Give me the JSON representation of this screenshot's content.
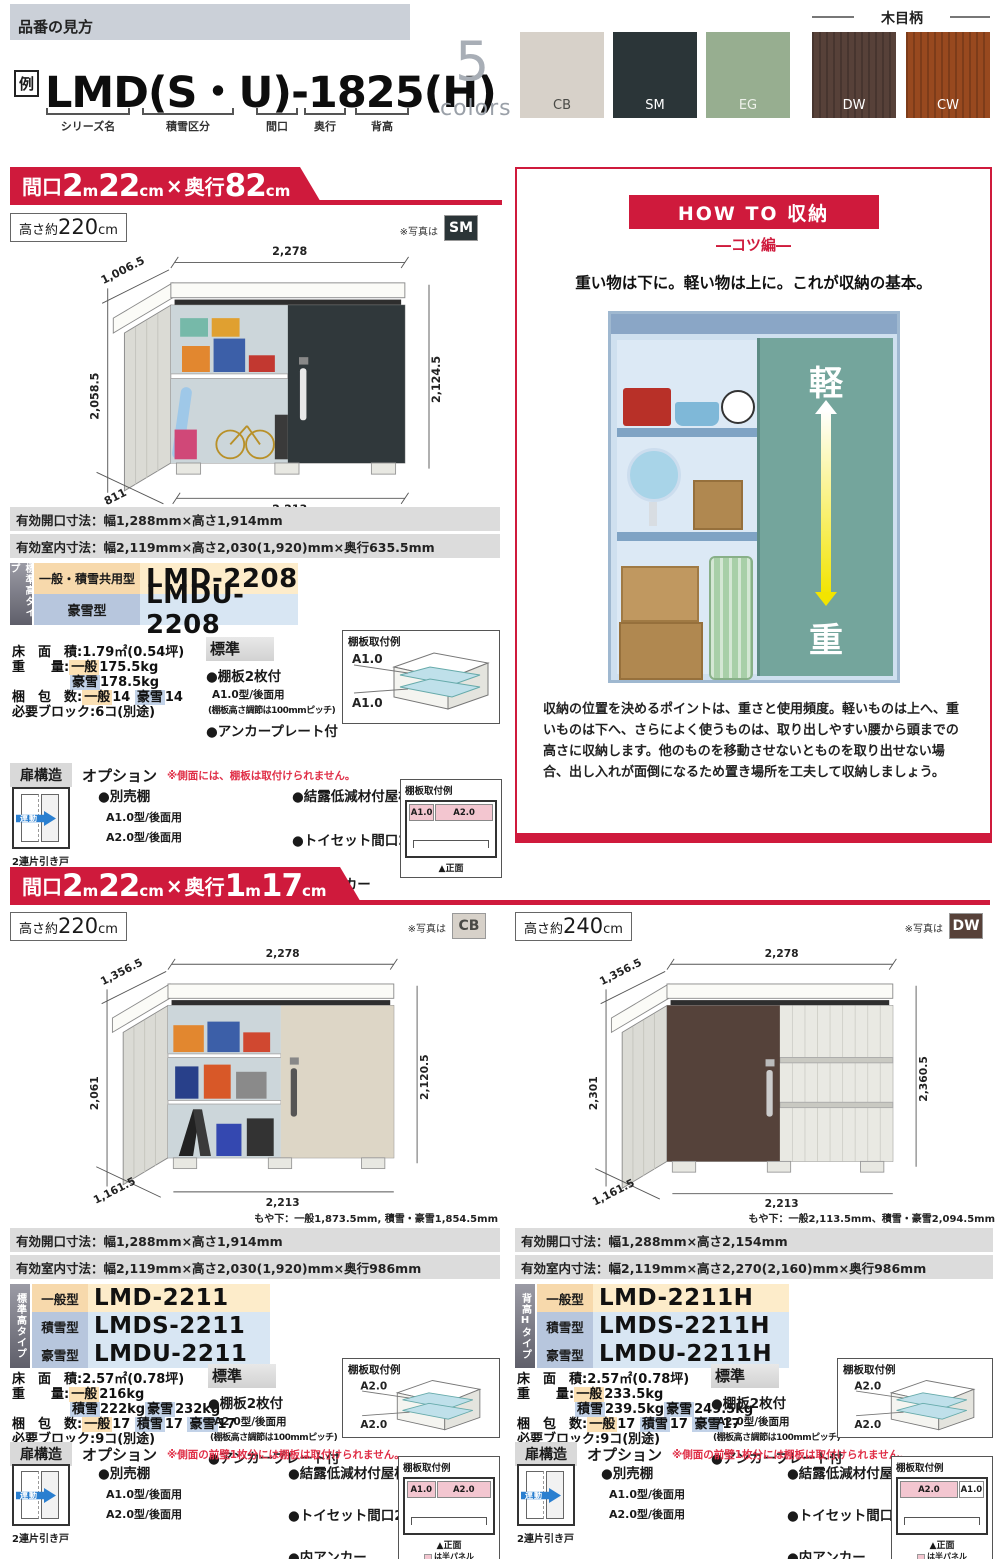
{
  "palette": {
    "red": "#cf1a3c"
  },
  "header": {
    "section_label": "品番の見方",
    "example_badge": "例",
    "model_example": "LMD(S・U)-1825(H)",
    "part_labels": [
      "シリーズ名",
      "積雪区分",
      "間口",
      "奥行",
      "背高"
    ],
    "colors_count": "5",
    "colors_word": "colors",
    "wood_grain_label": "木目柄",
    "swatches": [
      {
        "code": "CB",
        "bg": "#d7d1c9",
        "fg": "#4a4a46"
      },
      {
        "code": "SM",
        "bg": "#2b3538",
        "fg": "#ffffff"
      },
      {
        "code": "EG",
        "bg": "#97ae90",
        "fg": "#eef2ea"
      },
      {
        "code": "DW",
        "bg": "#574139",
        "fg": "#ffffff"
      },
      {
        "code": "CW",
        "bg": "#98491f",
        "fg": "#ffffff"
      }
    ]
  },
  "howto": {
    "title": "HOW TO 収納",
    "subtitle": "―コツ編―",
    "lead": "重い物は下に。軽い物は上に。これが収納の基本。",
    "light_char": "軽",
    "heavy_char": "重",
    "body": "収納の位置を決めるポイントは、重さと使用頻度。軽いものは上へ、重いものは下へ、さらによく使うものは、取り出しやすい腰から頭までの高さに収納します。他のものを移動させないとものを取り出せない場合、出し入れが面倒になるため置き場所を工夫して収納しましょう。"
  },
  "s1": {
    "banner": {
      "p1": "間口",
      "n1": "2",
      "u1": "m",
      "n2": "22",
      "u2": "cm",
      "x": "×",
      "p2": "奥行",
      "n3": "82",
      "u3": "cm"
    },
    "height": {
      "pre": "高さ約",
      "num": "220",
      "unit": "cm"
    },
    "photo_note": "※写真は",
    "photo_badge": {
      "code": "SM",
      "bg": "#2b3538",
      "fg": "#ffffff"
    },
    "dims": {
      "dtl": "1,006.5",
      "dt": "2,278",
      "dl": "2,058.5",
      "dr": "2,124.5",
      "dbl": "811",
      "db": "2,213"
    },
    "spec_open": "有効開口寸法：幅1,288mm×高さ1,914mm",
    "spec_inner": "有効室内寸法：幅2,119mm×高さ2,030(1,920)mm×奥行635.5mm",
    "models": {
      "tab": "標準高タイプ",
      "rows": [
        {
          "type": "一般・積雪共用型",
          "name": "LMD-2208"
        },
        {
          "type": "豪雪型",
          "name": "LMDU-2208"
        }
      ]
    },
    "specs": {
      "floor_l": "床　面　積:",
      "floor_v": "1.79㎡(0.54坪)",
      "weight_l": "重　　量:",
      "wt1_tag": "一般",
      "wt1_v": "175.5kg",
      "wt2_tag": "豪雪",
      "wt2_v": "178.5kg",
      "pack_l": "梱　包　数:",
      "pk1_tag": "一般",
      "pk1_v": "14",
      "pk2_tag": "豪雪",
      "pk2_v": "14",
      "block": "必要ブロック:6コ(別途)"
    },
    "standard": {
      "title": "標準",
      "i1": "●棚板2枚付",
      "i2": "A1.0型/後面用",
      "i3": "(棚板高さ調節は100mmピッチ)",
      "i4": "●アンカープレート付"
    },
    "shelf3d": {
      "title": "棚板取付例",
      "l1": "A1.0",
      "l2": "A1.0"
    },
    "dooropt": {
      "door_title": "扉構造",
      "opt_title": "オプション",
      "note": "※側面には、棚板は取付けられません。",
      "door_arrow": "連動",
      "door_caption": "2連片引き戸",
      "o1": "●別売棚",
      "o1a": "A1.0型/後面用",
      "o1b": "A2.0型/後面用",
      "o2": "●結露低減材付屋根",
      "o3": "●トイセット間口22用",
      "o4": "●内アンカー",
      "front": {
        "title": "棚板取付例",
        "c1": "A1.0",
        "c2": "A2.0",
        "caption": "▲正面"
      }
    }
  },
  "s2": {
    "banner": {
      "p1": "間口",
      "n1": "2",
      "u1": "m",
      "n2": "22",
      "u2": "cm",
      "x": "×",
      "p2": "奥行",
      "n3": "1",
      "u3": "m",
      "n4": "17",
      "u4": "cm"
    }
  },
  "s2l": {
    "height": {
      "pre": "高さ約",
      "num": "220",
      "unit": "cm"
    },
    "photo_note": "※写真は",
    "photo_badge": {
      "code": "CB",
      "bg": "#d7d1c9",
      "fg": "#4a4a46"
    },
    "dims": {
      "dtl": "1,356.5",
      "dt": "2,278",
      "dl": "2,061",
      "dr": "2,120.5",
      "dbl": "1,161.5",
      "db": "2,213"
    },
    "moya": "もや下：一般1,873.5mm, 積雪・豪雪1,854.5mm",
    "spec_open": "有効開口寸法：幅1,288mm×高さ1,914mm",
    "spec_inner": "有効室内寸法：幅2,119mm×高さ2,030(1,920)mm×奥行986mm",
    "models": {
      "tab": "標準高タイプ",
      "rows": [
        {
          "type": "一般型",
          "name": "LMD-2211"
        },
        {
          "type": "積雪型",
          "name": "LMDS-2211"
        },
        {
          "type": "豪雪型",
          "name": "LMDU-2211"
        }
      ]
    },
    "specs": {
      "floor_l": "床　面　積:",
      "floor_v": "2.57㎡(0.78坪)",
      "weight_l": "重　　量:",
      "wt1_tag": "一般",
      "wt1_v": "216kg",
      "wt2_tag": "積雪",
      "wt2_v": "222kg",
      "wt3_tag": "豪雪",
      "wt3_v": "232kg",
      "pack_l": "梱　包　数:",
      "pk1_tag": "一般",
      "pk1_v": "17",
      "pk2_tag": "積雪",
      "pk2_v": "17",
      "pk3_tag": "豪雪",
      "pk3_v": "17",
      "block": "必要ブロック:9コ(別途)"
    },
    "standard": {
      "title": "標準",
      "i1": "●棚板2枚付",
      "i2": "A2.0型/後面用",
      "i3": "(棚板高さ調節は100mmピッチ)",
      "i4": "●アンカープレート付"
    },
    "shelf3d": {
      "title": "棚板取付例",
      "l1": "A2.0",
      "l2": "A2.0"
    },
    "dooropt": {
      "door_title": "扉構造",
      "opt_title": "オプション",
      "note": "※側面の前壁1枚分には棚板は取付けられません。",
      "door_arrow": "連動",
      "door_caption": "2連片引き戸",
      "o1": "●別売棚",
      "o1a": "A1.0型/後面用",
      "o1b": "A2.0型/後面用",
      "o2": "●結露低減材付屋根",
      "o3": "●トイセット間口22用",
      "o4": "●内アンカー",
      "front": {
        "title": "棚板取付例",
        "c1": "A1.0",
        "c2": "A2.0",
        "caption": "▲正面",
        "legend": "は半パネル"
      }
    }
  },
  "s2r": {
    "height": {
      "pre": "高さ約",
      "num": "240",
      "unit": "cm"
    },
    "photo_note": "※写真は",
    "photo_badge": {
      "code": "DW",
      "bg": "#574139",
      "fg": "#ffffff"
    },
    "dims": {
      "dtl": "1,356.5",
      "dt": "2,278",
      "dl": "2,301",
      "dr": "2,360.5",
      "dbl": "1,161.5",
      "db": "2,213"
    },
    "moya": "もや下：一般2,113.5mm、積雪・豪雪2,094.5mm",
    "spec_open": "有効開口寸法：幅1,288mm×高さ2,154mm",
    "spec_inner": "有効室内寸法：幅2,119mm×高さ2,270(2,160)mm×奥行986mm",
    "models": {
      "tab": "背高Hタイプ",
      "rows": [
        {
          "type": "一般型",
          "name": "LMD-2211H"
        },
        {
          "type": "積雪型",
          "name": "LMDS-2211H"
        },
        {
          "type": "豪雪型",
          "name": "LMDU-2211H"
        }
      ]
    },
    "specs": {
      "floor_l": "床　面　積:",
      "floor_v": "2.57㎡(0.78坪)",
      "weight_l": "重　　量:",
      "wt1_tag": "一般",
      "wt1_v": "233.5kg",
      "wt2_tag": "積雪",
      "wt2_v": "239.5kg",
      "wt3_tag": "豪雪",
      "wt3_v": "249.5kg",
      "pack_l": "梱　包　数:",
      "pk1_tag": "一般",
      "pk1_v": "17",
      "pk2_tag": "積雪",
      "pk2_v": "17",
      "pk3_tag": "豪雪",
      "pk3_v": "17",
      "block": "必要ブロック:9コ(別途)"
    },
    "standard": {
      "title": "標準",
      "i1": "●棚板2枚付",
      "i2": "A2.0型/後面用",
      "i3": "(棚板高さ調節は100mmピッチ)",
      "i4": "●アンカープレート付"
    },
    "shelf3d": {
      "title": "棚板取付例",
      "l1": "A2.0",
      "l2": "A2.0"
    },
    "dooropt": {
      "door_title": "扉構造",
      "opt_title": "オプション",
      "note": "※側面の前壁1枚分には棚板は取付けられません。",
      "door_arrow": "連動",
      "door_caption": "2連片引き戸",
      "o1": "●別売棚",
      "o1a": "A1.0型/後面用",
      "o1b": "A2.0型/後面用",
      "o2": "●結露低減材付屋根",
      "o3": "●トイセット間口22用",
      "o4": "●内アンカー",
      "front": {
        "title": "棚板取付例",
        "c1": "A2.0",
        "c2": "A1.0",
        "caption": "▲正面",
        "legend": "は半パネル"
      }
    }
  }
}
